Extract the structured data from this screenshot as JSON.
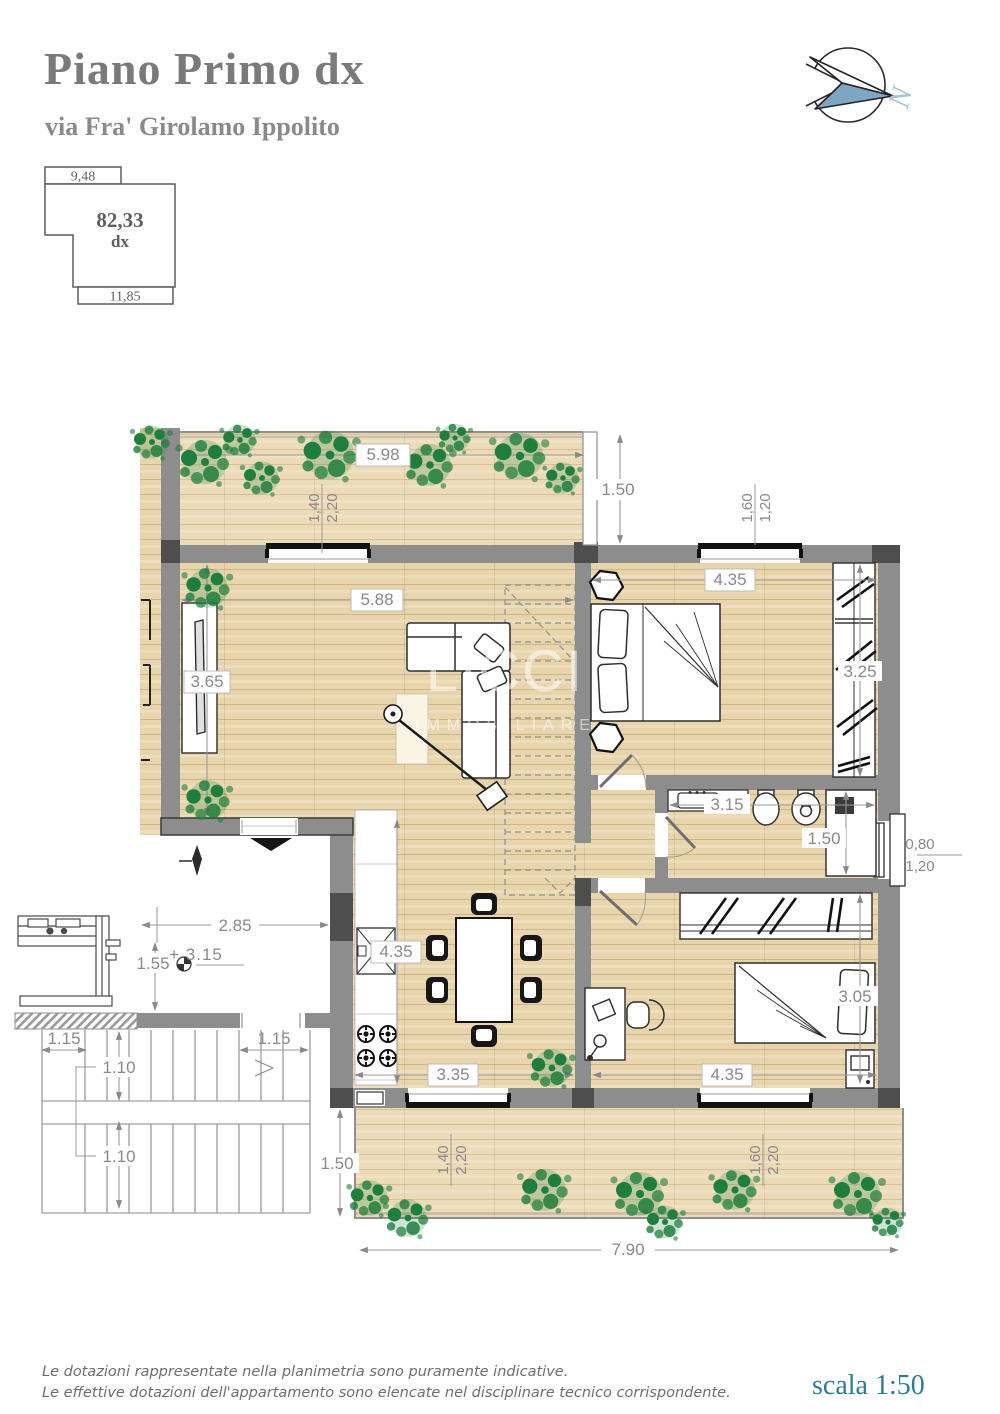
{
  "header": {
    "title": "Piano Primo dx",
    "subtitle": "via Fra' Girolamo Ippolito"
  },
  "keyplan": {
    "width_top": "9,48",
    "area": "82,33",
    "unit": "dx",
    "width_bottom": "11,85"
  },
  "compass": {
    "label": "N"
  },
  "watermark": {
    "line1": "LICCI",
    "line2": "IMMOBILIARE"
  },
  "dims": {
    "terrace_top_width": "5.98",
    "terrace_top_depth": "1.50",
    "living_width": "5.88",
    "living_depth": "3.65",
    "bedroom1_width": "4.35",
    "bedroom1_depth": "3.25",
    "bath_width": "3.15",
    "shower_depth": "1.50",
    "kitchen_depth": "4.35",
    "kitchen_width": "3.35",
    "bedroom2_width": "4.35",
    "bedroom2_depth": "3.05",
    "landing_width": "2.85",
    "landing_depth": "1.55",
    "level_mark": "+ 3.15",
    "stair_side_left": "1.15",
    "stair_side_right": "1.15",
    "stair_flight_upper": "1.10",
    "stair_flight_lower": "1.10",
    "terrace_bottom_depth": "1.50",
    "terrace_bottom_width": "7.90"
  },
  "windows": {
    "living_terrace": {
      "w": "1,40",
      "h": "2,20"
    },
    "bedroom1": {
      "w": "1,60",
      "h": "1,20"
    },
    "bath": {
      "w": "0,80",
      "h": "1,20"
    },
    "kitchen_terrace": {
      "w": "1,40",
      "h": "2,20"
    },
    "bedroom2_terrace": {
      "w": "1,60",
      "h": "2,20"
    }
  },
  "footer": {
    "disclaimer1": "Le dotazioni rappresentate nella planimetria sono puramente indicative.",
    "disclaimer2": "Le effettive dotazioni dell'appartamento sono elencate nel disciplinare tecnico corrispondente.",
    "scale": "scala 1:50"
  },
  "colors": {
    "wood": "#e9d5ab",
    "wall": "#8d8d8d",
    "wall_dark": "#4e4e4e",
    "plant_green": "#1d7f3d",
    "dim_text": "#8a8a8a",
    "scale_text": "#2a7d96",
    "compass_blue": "#7fa6c0"
  }
}
